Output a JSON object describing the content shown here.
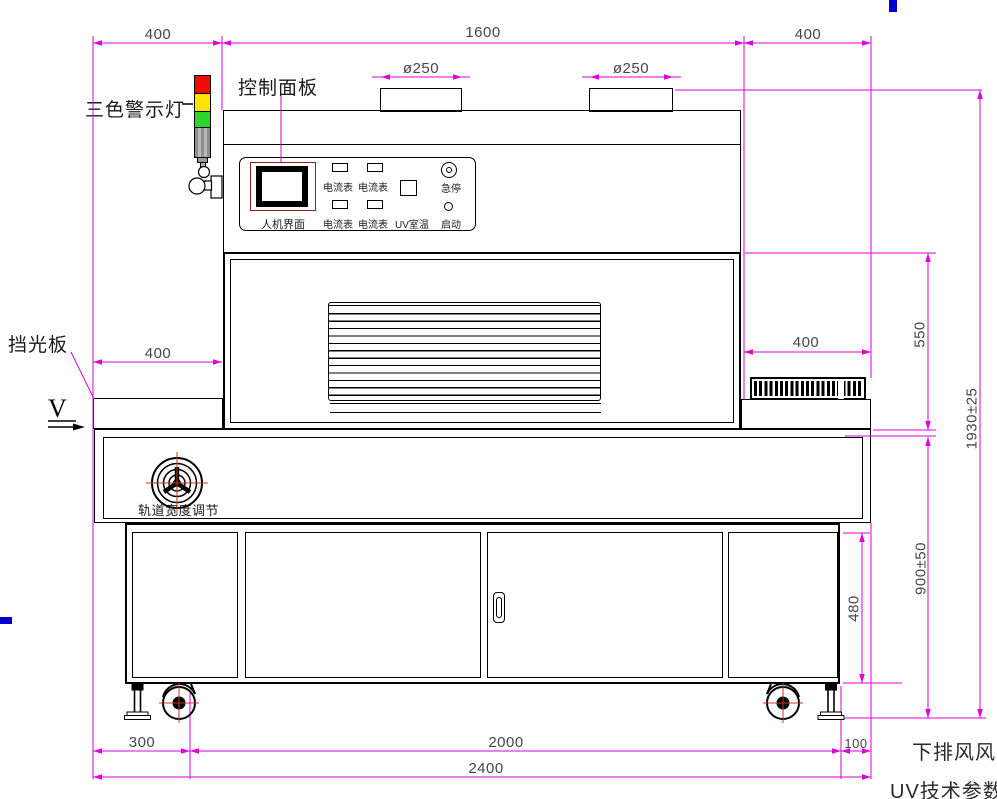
{
  "drawing": {
    "title_labels": {
      "warning_light": "三色警示灯",
      "control_panel": "控制面板",
      "light_shield": "挡光板",
      "view_marker": "V",
      "track_width_adjust": "轨道宽度调节",
      "note_exhaust": "下排风风",
      "note_uv": "UV技术参数"
    },
    "panel": {
      "hmi": "人机界面",
      "ammeter": "电流表",
      "uv_temp": "UV室温",
      "estop": "急停",
      "start": "启动"
    },
    "dims": {
      "top_left": "400",
      "top_mid": "1600",
      "top_right": "400",
      "duct_left": "ø250",
      "duct_right": "ø250",
      "mid_left": "400",
      "mid_right": "400",
      "h_upper": "550",
      "h_total": "1930±25",
      "h_table": "900±50",
      "h_cabinet": "480",
      "b_left": "300",
      "b_mid": "2000",
      "b_right": "100",
      "b_total": "2400"
    },
    "colors": {
      "dim_line": "#dd00dd",
      "warn_red": "#f00c00",
      "warn_yellow": "#ffe400",
      "warn_green": "#2cd42c",
      "warn_gray": "#9a9a9a",
      "hmi_frame": "#8b2525",
      "crosshair_red": "#c0392b",
      "accent_blue": "#0000cc"
    }
  }
}
